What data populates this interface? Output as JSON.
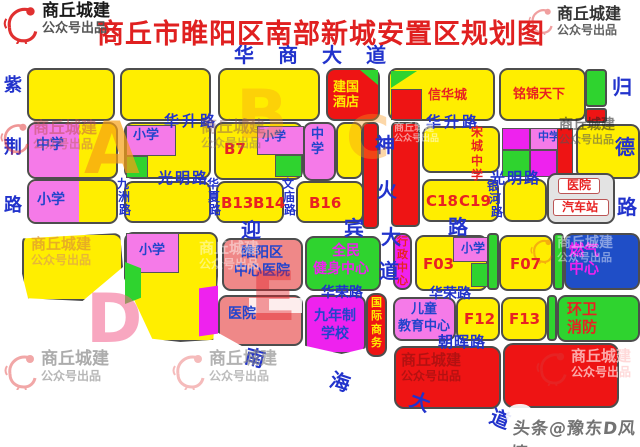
{
  "title": "商丘市睢阳区南部新城安置区规划图",
  "watermark": {
    "line1": "商丘城建",
    "line2": "公众号出品"
  },
  "credit": "头条@豫东D风情",
  "palette": {
    "block_yellow": "#ffee00",
    "school_pink": "#f57ae8",
    "magenta": "#ee22ee",
    "green": "#2fd32f",
    "red": "#ee1414",
    "salmon": "#ef8888",
    "deep_blue": "#1f4ec7",
    "road_text_blue": "#2233cc",
    "label_red": "#e82222",
    "label_blue": "#2244cc",
    "title_red": "#e02020"
  },
  "roads": {
    "huashang": "华商大道",
    "huasheng_w": "华升路",
    "huasheng_e": "华升路",
    "guangming_w": "光明路",
    "guangming_e": "光明路",
    "yingbin": {
      "ying": "迎",
      "bin": "宾"
    },
    "lu_east": "路",
    "huarong_w": "华荣路",
    "huarong_e": "华荣路",
    "zhaohui": "朝晖路",
    "zijing": [
      "紫",
      "荆",
      "路"
    ],
    "jiuzhou": [
      "九",
      "洲",
      "路"
    ],
    "huaxia": [
      "华",
      "夏",
      "路"
    ],
    "wenmiao": [
      "文",
      "庙",
      "路"
    ],
    "shenhuo": [
      "神",
      "火",
      "大",
      "道"
    ],
    "yinhe": [
      "银",
      "河",
      "路"
    ],
    "guide": [
      "归",
      "德",
      "路"
    ],
    "nanhai": [
      "南",
      "海",
      "大",
      "道"
    ],
    "songcheng": "宋\n城\n中\n学"
  },
  "blocks": {
    "jianguo": "建国\n酒店",
    "xinhuacheng": "信华城",
    "mingjin": "铭锦天下",
    "zhongxue": "中学",
    "zhongxue_v": "中\n学",
    "xiaoxue": "小学",
    "b7": "B7",
    "b13": "B13",
    "b14": "B14",
    "b16": "B16",
    "c18": "C18",
    "c19": "C19",
    "f03": "F03",
    "f07": "F07",
    "f12": "F12",
    "f13": "F13",
    "yiyuan": "医院",
    "qichezhan": "汽车站",
    "suiyang1": "睢阳区",
    "suiyang2": "中心医院",
    "quanmin1": "全民",
    "quanmin2": "健身中心",
    "xingzheng": "行\n政\n中\n心",
    "ranqi1": "燃气",
    "ranqi2": "中心",
    "guoji": "国\n际\n商\n务",
    "ertong1": "儿童",
    "ertong2": "教育中心",
    "jiunian1": "九年制",
    "jiunian2": "学校",
    "huanwei1": "环卫",
    "huanwei2": "消防"
  },
  "zones": {
    "a": "A",
    "b": "B",
    "c": "C",
    "d": "D",
    "e": "E"
  }
}
